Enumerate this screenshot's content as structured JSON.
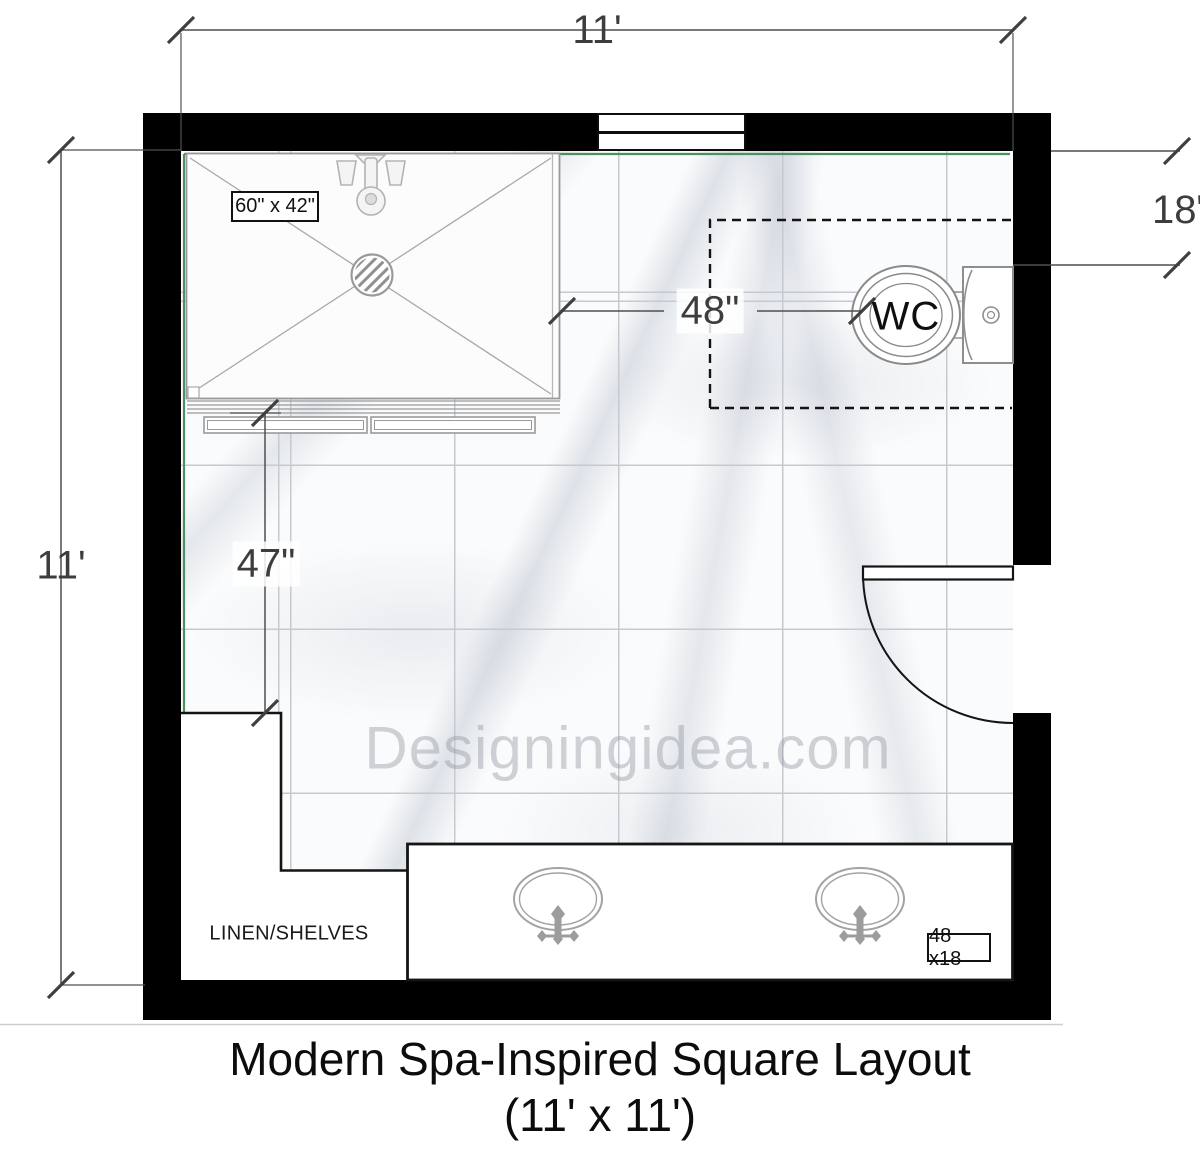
{
  "plan": {
    "title_line1": "Modern Spa-Inspired Square Layout",
    "title_line2": "(11' x 11')",
    "watermark": "Designingidea.com",
    "dimensions": {
      "width": "11'",
      "height": "11'",
      "wc_to_shower": "48\"",
      "wc_wall_offset": "18\"",
      "linen_to_shower": "47\""
    },
    "fixtures": {
      "shower_size": "60\" x 42\"",
      "toilet": "WC",
      "vanity_size": "48 x18",
      "linen": "LINEN/SHELVES"
    },
    "colors": {
      "wall": "#000000",
      "room_outline": "#4f8f5f",
      "dimension_line": "#4f4f4f",
      "fixture_stroke": "#9a9a9a",
      "tile_grout": "#c6cad0",
      "watermark": "#9aa0a8"
    }
  }
}
